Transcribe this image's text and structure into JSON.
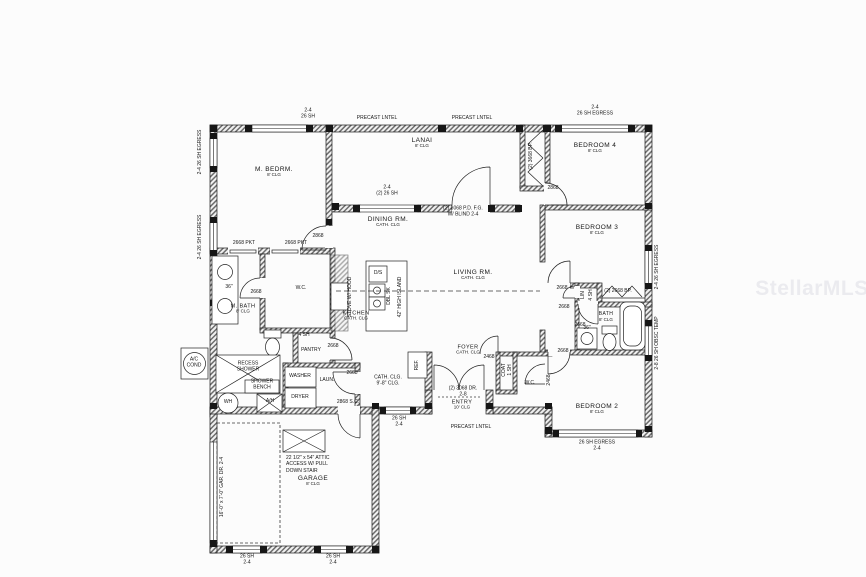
{
  "watermark": "StellarMLS",
  "rooms": {
    "m_bedrm": {
      "name": "M. BEDRM.",
      "clg": "8' CLG"
    },
    "lanai": {
      "name": "LANAI",
      "clg": "8' CLG"
    },
    "bedroom4": {
      "name": "BEDROOM 4",
      "clg": "8' CLG"
    },
    "bedroom3": {
      "name": "BEDROOM 3",
      "clg": "8' CLG"
    },
    "bedroom2": {
      "name": "BEDROOM 2",
      "clg": "8' CLG"
    },
    "dining": {
      "name": "DINING RM.",
      "clg": "CATH. CLG"
    },
    "living": {
      "name": "LIVING RM.",
      "clg": "CATH. CLG"
    },
    "kitchen": {
      "name": "KITCHEN",
      "clg": "CATH. CLG"
    },
    "foyer": {
      "name": "FOYER",
      "clg": "CATH. CLG"
    },
    "entry": {
      "name": "ENTRY",
      "clg": "10' CLG"
    },
    "m_bath": {
      "name": "M. BATH",
      "clg": "8' CLG"
    },
    "bath": {
      "name": "BATH",
      "clg": "8' CLG"
    },
    "garage": {
      "name": "GARAGE",
      "clg": "8' CLG"
    },
    "laundry": {
      "name": "LAUN."
    },
    "pantry": {
      "name": "PANTRY"
    },
    "wc_master": {
      "name": "W.C."
    },
    "wc_bed2": {
      "name": "W.C."
    }
  },
  "fixtures": {
    "washer": "WASHER",
    "dryer": "DRYER",
    "water_heater": "WH",
    "air_handler": "A/H",
    "ac_1": "A/C",
    "ac_2": "COND",
    "recess_1": "RECESS",
    "recess_2": "SHOWER",
    "bench_1": "SHOWER",
    "bench_2": "BENCH",
    "dishwasher": "D/S",
    "dbl_sink": "DBL SK",
    "island": "42\" HIGH ISLAND",
    "stove": "STOVE W/ HOOD",
    "fridge": "REF.",
    "linen": "LIN",
    "linen_sh": "4 SH",
    "coat": "COAT",
    "coat_sh": "1 SH",
    "vanity_m": "36\"",
    "vanity_b": "36\"",
    "pantry_sh": "4 SH"
  },
  "doors": {
    "pkt1": "2668 PKT",
    "pkt2": "2668 PKT",
    "m_bedrm": "2868",
    "m_wc": "2668",
    "pantry": "2668",
    "laundry": "2668",
    "garage_sc": "2868 S.C.",
    "bed4": "2868",
    "bed4_closet": "(2) 3668 BP.",
    "bed3": "2668",
    "bed3_closet": "(2) 2668 BP.",
    "linen": "2668",
    "bath": "2668",
    "bed2": "2668",
    "wc2": "2468",
    "coat": "2468",
    "entry_1": "(2) 3068 DR.",
    "entry_2": "2-8",
    "patio_1": "(2) 3068 P.D. F.G.",
    "patio_2": "W/ BLIND 2-4",
    "garage_dr": "16'-0\" x 7'-0\" GAR. DR. 2-4"
  },
  "windows": {
    "lintel": "PRECAST LNTEL",
    "m_top_1": "2-4",
    "m_top_2": "26 SH",
    "left_egress": "2-4  26 SH EGRESS",
    "bed4_1": "2-4",
    "bed4_2": "26 SH EGRESS",
    "lanai_1": "2-4",
    "lanai_2": "(2) 26 SH",
    "bed3_v": "2-4  26 SH EGRESS",
    "bath_v": "2-8  26 SH OBSC TEMP",
    "bed2_1": "26 SH EGRESS",
    "bed2_2": "2-4",
    "hall_1": "26 SH",
    "hall_2": "2-4",
    "gar_1": "26 SH",
    "gar_2": "2-4"
  },
  "notes": {
    "attic_1": "22 1/2\" x 54\" ATTIC",
    "attic_2": "ACCESS W/ PULL",
    "attic_3": "DOWN STAIR",
    "hall_clg_1": "CATH. CLG.",
    "hall_clg_2": "9'-8\" CLG."
  }
}
